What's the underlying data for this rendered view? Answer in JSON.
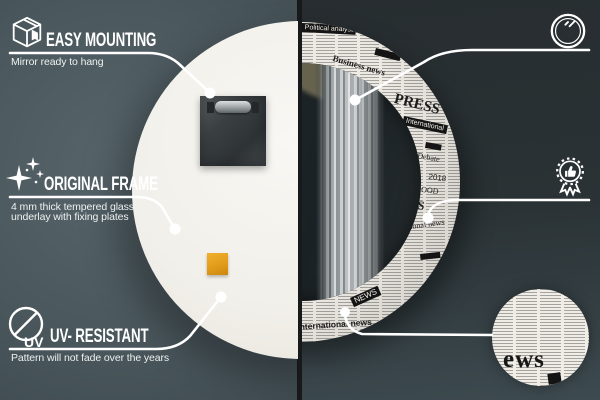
{
  "colors": {
    "left_background": "#4b585d",
    "right_background": "#2a3235",
    "divider": "#17191b",
    "annotation": "#ffffff",
    "newsprint": "#edeae3",
    "sticker": "#e09a19"
  },
  "icons": {
    "easy_mounting": "package-box-icon",
    "top_class_mirror": "round-mirror-icon",
    "original_frame": "sparkles-icon",
    "unique_design": "award-rosette-thumbs-up-icon",
    "uv_resistant": "uv-no-sun-icon"
  },
  "callouts": {
    "easy_mounting": {
      "title": "EASY MOUNTING",
      "line1": "Mirror ready to hang"
    },
    "top_class_mirror": {
      "title": "A TOP-CLASS MIRROR",
      "line1": "A perfectly smooth surface",
      "line2": "that does not distort the reflection."
    },
    "original_frame": {
      "title": "ORIGINAL FRAME",
      "line1": "4 mm thick tempered glass",
      "line2": "underlay with fixing plates"
    },
    "unique_design": {
      "title": "UNIQUE DESIGN",
      "line1": "Timeless patterns",
      "line2": "for any interior"
    },
    "uv_resistant": {
      "title": "UV- RESISTANT",
      "line1": "Pattern will not fade over the years",
      "icon_label": "UV"
    }
  },
  "mirror": {
    "front_words": [
      {
        "text": "Political analyst",
        "x": 162,
        "y": 1,
        "s": 7,
        "r": 3,
        "boxed": true
      },
      {
        "text": "Business news",
        "x": 194,
        "y": 32,
        "s": 9,
        "r": 16,
        "serif": true,
        "w": 700
      },
      {
        "text": "PRESS",
        "x": 256,
        "y": 70,
        "s": 15,
        "r": 14,
        "serif": true,
        "w": 700
      },
      {
        "text": "International",
        "x": 264,
        "y": 94,
        "s": 7,
        "r": 12,
        "boxed": true
      },
      {
        "text": "Debate",
        "x": 278,
        "y": 130,
        "s": 8,
        "r": 10,
        "serif": true
      },
      {
        "text": "2018",
        "x": 289,
        "y": 151,
        "s": 8,
        "r": 8
      },
      {
        "text": "GOOD",
        "x": 276,
        "y": 163,
        "s": 8,
        "r": 8,
        "serif": true
      },
      {
        "text": "SS",
        "x": 272,
        "y": 176,
        "s": 12,
        "r": 8,
        "serif": true,
        "w": 700
      },
      {
        "text": "ational news",
        "x": 264,
        "y": 202,
        "s": 8,
        "r": -8,
        "serif": true
      },
      {
        "text": "NEWS",
        "x": 210,
        "y": 276,
        "s": 8,
        "r": -24,
        "boxed": true
      },
      {
        "text": "International news",
        "x": 157,
        "y": 301,
        "s": 8.5,
        "r": -4,
        "w": 700
      }
    ],
    "detail_word": "ews"
  }
}
